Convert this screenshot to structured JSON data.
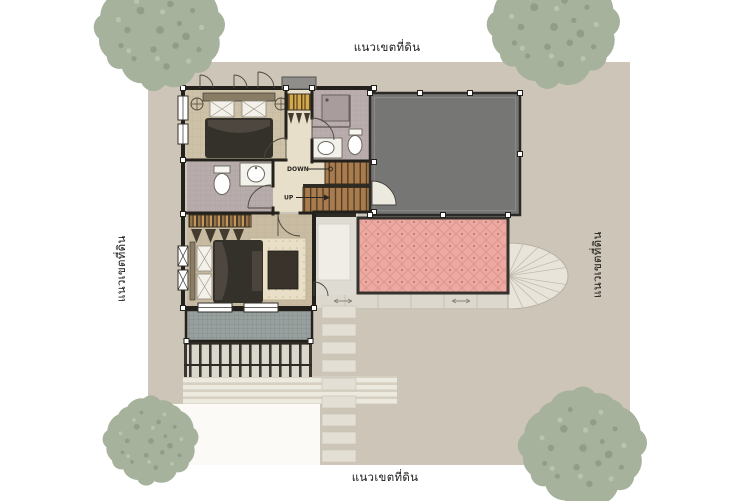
{
  "labels": {
    "boundary_top": "แนวเขตที่ดิน",
    "boundary_bottom": "แนวเขตที่ดิน",
    "boundary_left": "แนวเขตที่ดิน",
    "boundary_right": "แนวเขตที่ดิน"
  },
  "stairs": {
    "down_label": "DOWN",
    "up_label": "UP"
  },
  "colors": {
    "page_background": "#ffffff",
    "plot_ground": "#cdc5b8",
    "tree_foliage": "#a7b29d",
    "roof_gray": "#767674",
    "terrace_pink": "#eeaaa2",
    "wall_dark": "#24211c",
    "bedroom_floor": "#cdc1a8",
    "bathroom_floor": "#b7abab",
    "hall_floor": "#e7dfca",
    "stair_wood": "#a87c4e",
    "balcony_gray": "#98a09f",
    "paving_light": "#e3dfd5",
    "driveway_white": "#fbfaf6"
  }
}
